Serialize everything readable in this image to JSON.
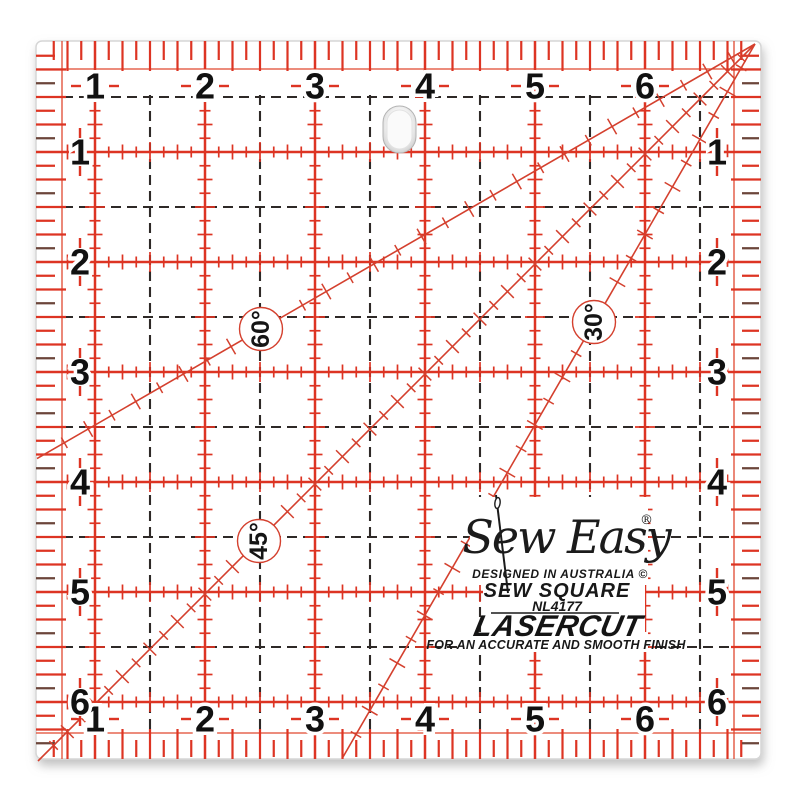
{
  "product": {
    "brand_logo": "Sew Easy",
    "registered_mark": "®",
    "designed_in": "DESIGNED IN AUSTRALIA ©",
    "product_name": "SEW SQUARE",
    "model_number": "NL4177",
    "feature": "LASERCUT",
    "tagline": "FOR AN  ACCURATE AND SMOOTH FINISH"
  },
  "ruler": {
    "numbers_top": [
      "6",
      "5",
      "4",
      "3",
      "2",
      "1"
    ],
    "numbers_bottom": [
      "6",
      "5",
      "4",
      "3",
      "2",
      "1"
    ],
    "numbers_left": [
      "1",
      "2",
      "3",
      "4",
      "5",
      "6"
    ],
    "numbers_right": [
      "1",
      "2",
      "3",
      "4",
      "5",
      "6"
    ],
    "angle_labels": [
      "60°",
      "45°",
      "30°"
    ]
  },
  "colors": {
    "grid_red": "#dd3423",
    "quarter_line_red": "#e0482f",
    "diagonal_red": "#d4402e",
    "dark_tick": "#6b453a",
    "dash_black": "#2e2927",
    "number_black": "#111111"
  }
}
